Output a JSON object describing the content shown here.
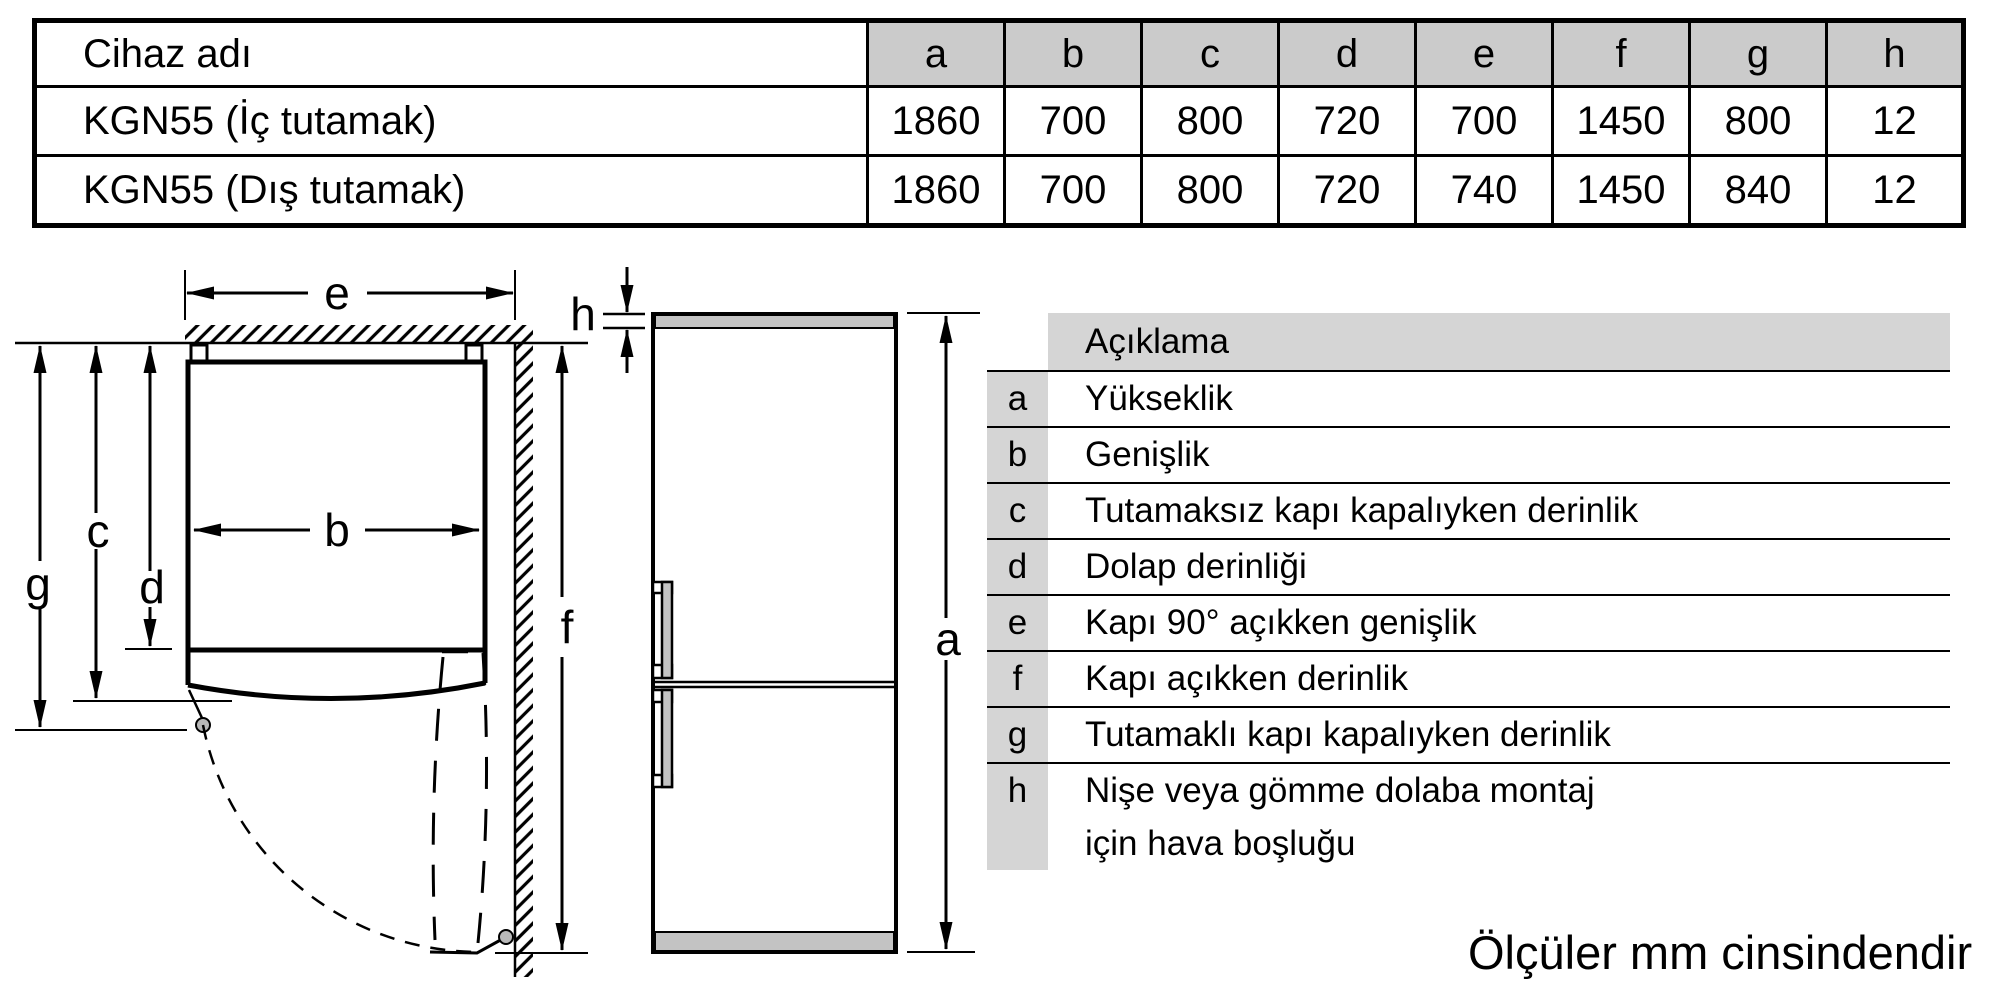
{
  "spec_table": {
    "name_header": "Cihaz adı",
    "columns": [
      "a",
      "b",
      "c",
      "d",
      "e",
      "f",
      "g",
      "h"
    ],
    "rows": [
      {
        "name": "KGN55 (İç tutamak)",
        "values": [
          "1860",
          "700",
          "800",
          "720",
          "700",
          "1450",
          "800",
          "12"
        ]
      },
      {
        "name": "KGN55 (Dış tutamak)",
        "values": [
          "1860",
          "700",
          "800",
          "720",
          "740",
          "1450",
          "840",
          "12"
        ]
      }
    ]
  },
  "legend": {
    "header": "Açıklama",
    "rows": [
      {
        "key": "a",
        "label": "Yükseklik"
      },
      {
        "key": "b",
        "label": "Genişlik"
      },
      {
        "key": "c",
        "label": "Tutamaksız kapı kapalıyken derinlik"
      },
      {
        "key": "d",
        "label": "Dolap derinliği"
      },
      {
        "key": "e",
        "label": "Kapı 90° açıkken genişlik"
      },
      {
        "key": "f",
        "label": "Kapı açıkken derinlik"
      },
      {
        "key": "g",
        "label": "Tutamaklı kapı kapalıyken derinlik"
      },
      {
        "key": "h",
        "label": "Nişe veya gömme dolaba montaj\niçin hava boşluğu"
      }
    ]
  },
  "diagram": {
    "labels": {
      "a": "a",
      "b": "b",
      "c": "c",
      "d": "d",
      "e": "e",
      "f": "f",
      "g": "g",
      "h": "h"
    }
  },
  "footer_note": "Ölçüler mm cinsindendir",
  "colors": {
    "table_header_gray": "#cbcbcb",
    "legend_gray": "#d5d5d5",
    "appliance_gray": "#c3c3c3",
    "hinge_dot_gray": "#b8b8b8",
    "line_black": "#000000"
  }
}
